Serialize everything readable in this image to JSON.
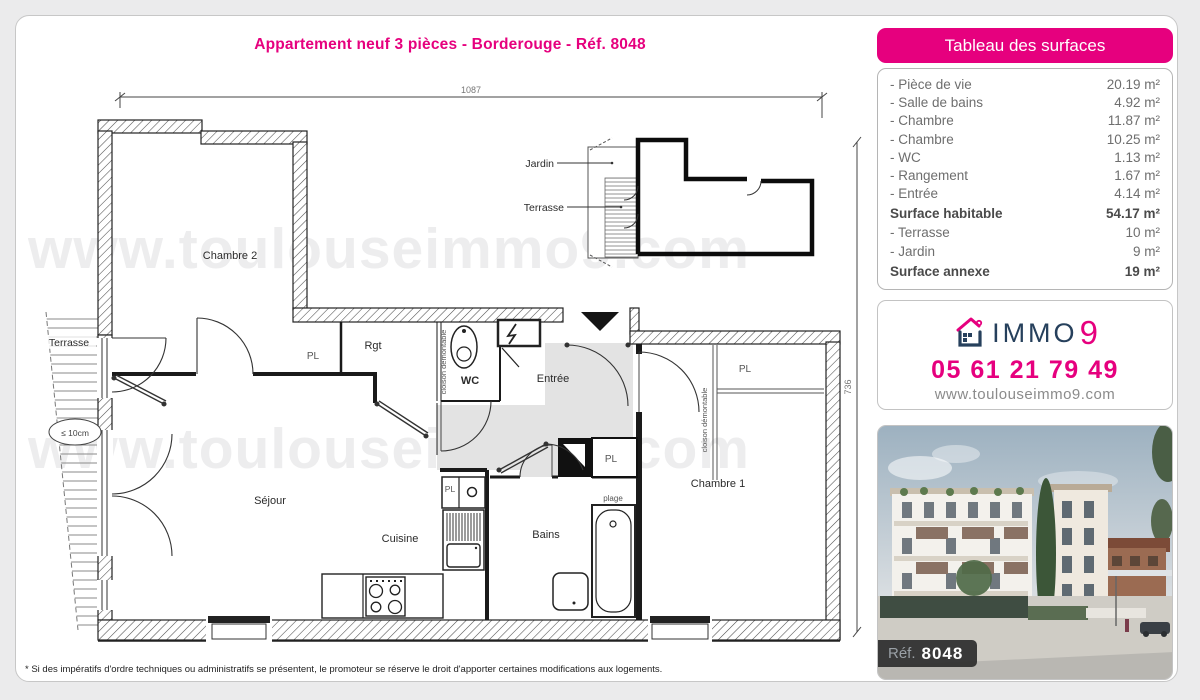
{
  "page": {
    "title": "Appartement neuf 3 pièces - Borderouge - Réf. 8048",
    "footnote": "* Si des impératifs d'ordre techniques ou administratifs se présentent, le promoteur se réserve le droit d'apporter certaines modifications aux logements.",
    "watermark": "www.toulouseimmo9.com"
  },
  "plan": {
    "rooms": {
      "chambre2": "Chambre 2",
      "sejour": "Séjour",
      "cuisine": "Cuisine",
      "bains": "Bains",
      "wc": "WC",
      "rgt": "Rgt",
      "entree": "Entrée",
      "chambre1": "Chambre 1",
      "terrasse": "Terrasse"
    },
    "labels": {
      "pl": "PL",
      "plage": "plage",
      "cloison": "cloison démontable",
      "depth": "≤ 10cm"
    },
    "dims": {
      "width": "1087",
      "height": "736"
    },
    "siteplan": {
      "jardin": "Jardin",
      "terrasse": "Terrasse"
    }
  },
  "surfaces": {
    "header": "Tableau des surfaces",
    "rows": [
      {
        "label": "- Pièce de vie",
        "value": "20.19 m²"
      },
      {
        "label": "- Salle de bains",
        "value": "4.92 m²"
      },
      {
        "label": "- Chambre",
        "value": "11.87 m²"
      },
      {
        "label": "- Chambre",
        "value": "10.25 m²"
      },
      {
        "label": "- WC",
        "value": "1.13 m²"
      },
      {
        "label": "- Rangement",
        "value": "1.67 m²"
      },
      {
        "label": "- Entrée",
        "value": "4.14 m²"
      },
      {
        "label": "Surface habitable",
        "value": "54.17 m²"
      },
      {
        "label": "- Terrasse",
        "value": "10 m²"
      },
      {
        "label": "- Jardin",
        "value": "9 m²"
      },
      {
        "label": "Surface annexe",
        "value": "19 m²"
      }
    ]
  },
  "agency": {
    "brand": "IMMO",
    "brand_digit": "9",
    "phone": "05 61 21 79 49",
    "website": "www.toulouseimmo9.com"
  },
  "photo": {
    "ref_label": "Réf.",
    "ref_number": "8048"
  },
  "colors": {
    "accent": "#e6007e",
    "navy": "#26405c"
  }
}
